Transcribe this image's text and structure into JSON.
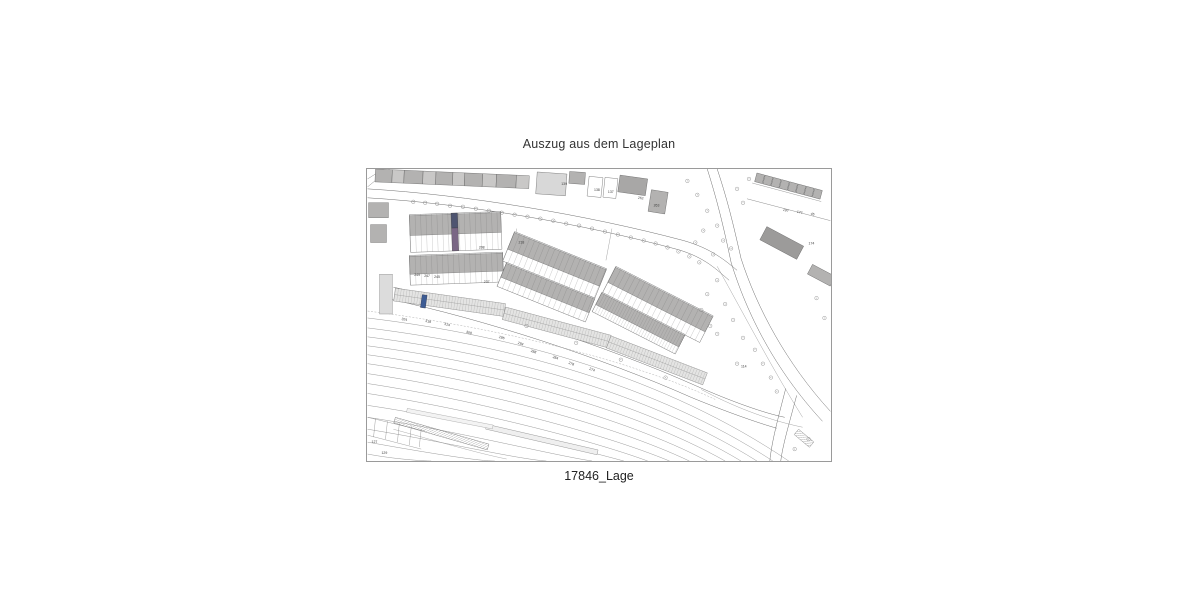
{
  "title": "Auszug aus dem Lageplan",
  "caption": "17846_Lage",
  "map": {
    "highlight_primary_top": "#4e5470",
    "highlight_primary_bottom": "#7a6685",
    "highlight_secondary": "#3d5c94",
    "building_fill": "#b3b2b1",
    "building_fill_light": "#d8d8d8",
    "line_color": "#6b6b6b",
    "rail_color": "#8f8f8f",
    "labels": [
      {
        "text": "139"
      },
      {
        "text": "138"
      },
      {
        "text": "137"
      },
      {
        "text": "262"
      },
      {
        "text": "263"
      },
      {
        "text": "218"
      },
      {
        "text": "208"
      },
      {
        "text": "249"
      },
      {
        "text": "247"
      },
      {
        "text": "245"
      },
      {
        "text": "237"
      },
      {
        "text": "324"
      },
      {
        "text": "318"
      },
      {
        "text": "314"
      },
      {
        "text": "308"
      },
      {
        "text": "296"
      },
      {
        "text": "294"
      },
      {
        "text": "288"
      },
      {
        "text": "284"
      },
      {
        "text": "278"
      },
      {
        "text": "274"
      },
      {
        "text": "114"
      },
      {
        "text": "127"
      },
      {
        "text": "129"
      },
      {
        "text": "197"
      },
      {
        "text": "177"
      },
      {
        "text": "45"
      },
      {
        "text": "174"
      }
    ]
  }
}
